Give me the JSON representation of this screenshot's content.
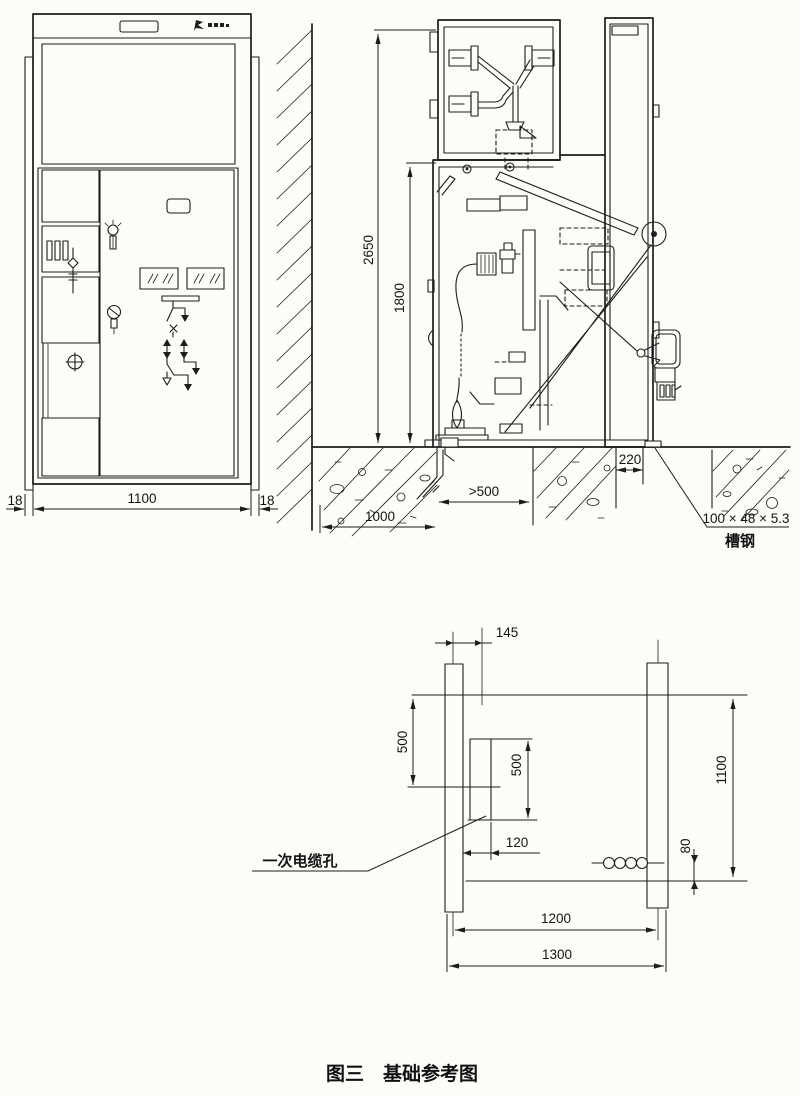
{
  "caption": "图三　基础参考图",
  "colors": {
    "ink": "#1d1d1d",
    "paper": "#fcfcf9"
  },
  "front_view": {
    "dims": {
      "flange_left": "18",
      "width": "1100",
      "flange_right": "18"
    }
  },
  "side_view": {
    "dims": {
      "total_height": "2650",
      "lower_height": "1800",
      "rear_gap": "220",
      "front_trench": ">500",
      "left_foundation": "1000"
    },
    "labels": {
      "channel_steel_size": "100 × 48 × 5.3",
      "channel_steel": "槽钢"
    }
  },
  "foundation_plan": {
    "dims": {
      "hole_center_offset": "145",
      "front_edge": "500",
      "hole_length": "500",
      "hole_width": "120",
      "depth": "1100",
      "hole_row_offset": "80",
      "rail_span": "1200",
      "overall": "1300"
    },
    "labels": {
      "primary_cable_hole": "一次电缆孔"
    }
  }
}
